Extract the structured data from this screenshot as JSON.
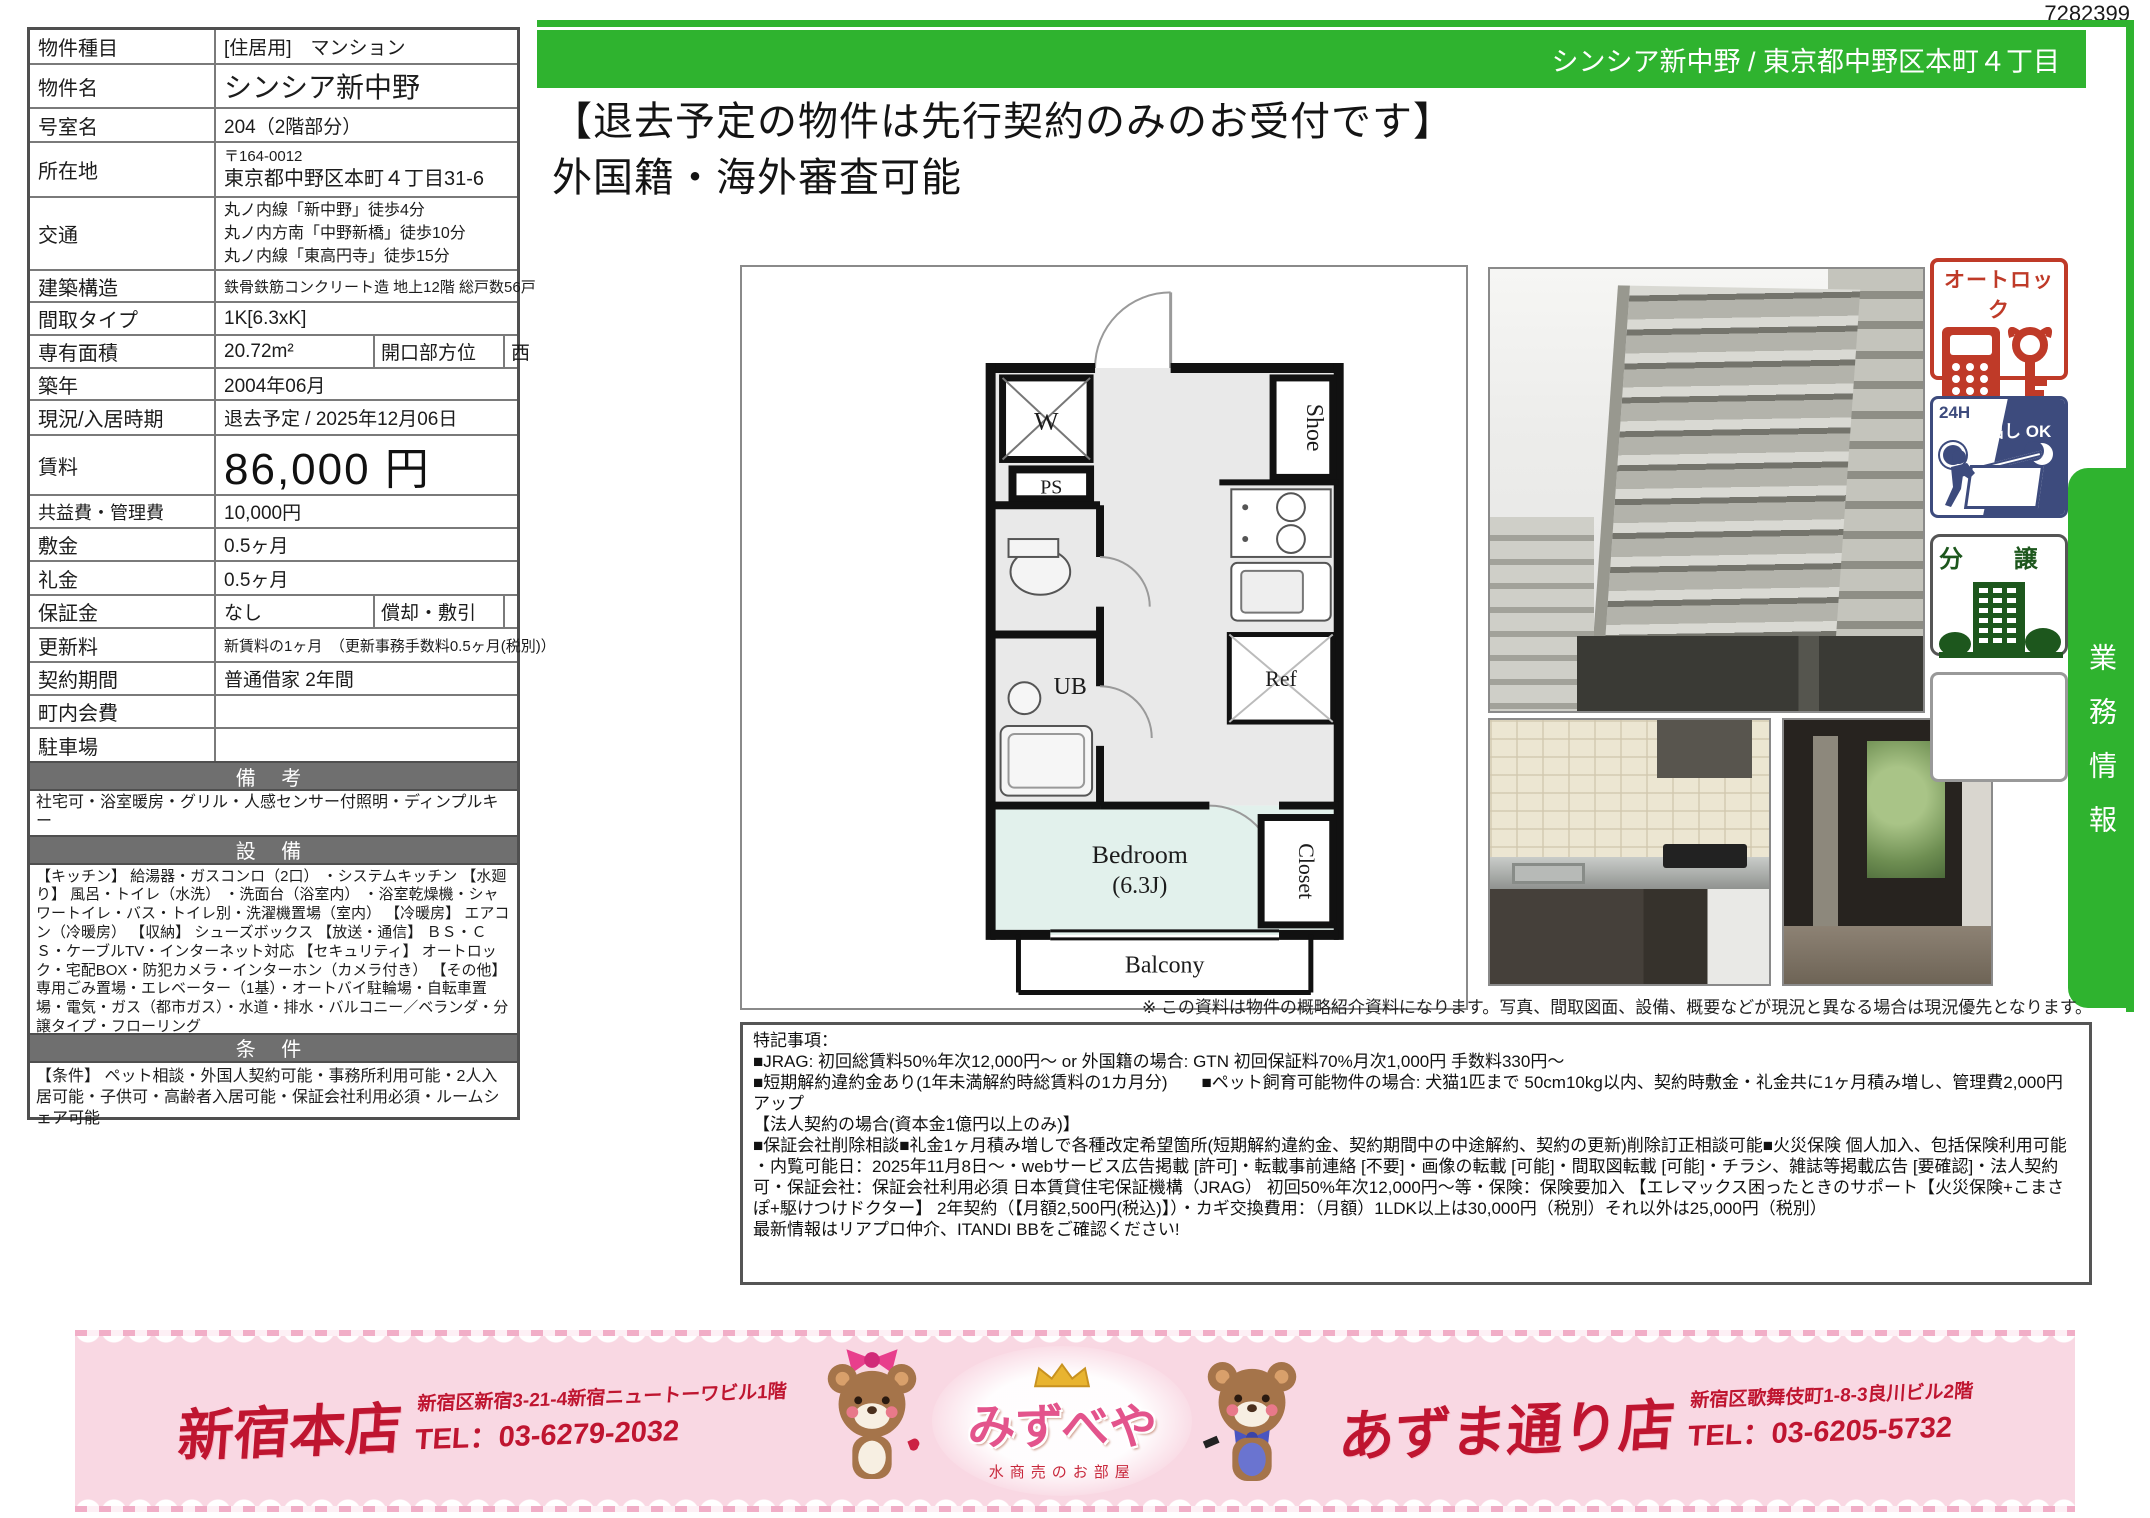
{
  "doc": {
    "id": "7282399"
  },
  "colors": {
    "accent_green": "#2fb32f",
    "section_gray": "#6f6f6f",
    "autolock_red": "#bf3a28",
    "gomidashi_navy": "#3d4b7d",
    "bunjo_green": "#1d571d",
    "banner_pink": "#f9d8e3",
    "banner_red": "#bf1530"
  },
  "header": {
    "bar_text": "シンシア新中野 / 東京都中野区本町４丁目",
    "headline_line1": "【退去予定の物件は先行契約のみのお受付です】",
    "headline_line2": "外国籍・海外審査可能"
  },
  "table": {
    "rows": [
      {
        "label": "物件種目",
        "value": "[住居用]　マンション"
      },
      {
        "label": "物件名",
        "value": "シンシア新中野"
      },
      {
        "label": "号室名",
        "value": "204（2階部分）"
      },
      {
        "label": "所在地",
        "value_line1": "〒164-0012",
        "value_line2": "東京都中野区本町４丁目31-6"
      },
      {
        "label": "交通",
        "lines": [
          "丸ノ内線「新中野」徒歩4分",
          "丸ノ内方南「中野新橋」徒歩10分",
          "丸ノ内線「東高円寺」徒歩15分"
        ]
      },
      {
        "label": "建築構造",
        "value": "鉄骨鉄筋コンクリート造 地上12階 総戸数56戸"
      },
      {
        "label": "間取タイプ",
        "value": "1K[6.3xK]"
      },
      {
        "label": "専有面積",
        "value": "20.72m²",
        "label2": "開口部方位",
        "value2": "西"
      },
      {
        "label": "築年",
        "value": "2004年06月"
      },
      {
        "label": "現況/入居時期",
        "value": "退去予定 / 2025年12月06日"
      },
      {
        "label": "賃料",
        "value": "86,000 円"
      },
      {
        "label": "共益費・管理費",
        "value": "10,000円"
      },
      {
        "label": "敷金",
        "value": "0.5ヶ月"
      },
      {
        "label": "礼金",
        "value": "0.5ヶ月"
      },
      {
        "label": "保証金",
        "value": "なし",
        "label2": "償却・敷引",
        "value2": ""
      },
      {
        "label": "更新料",
        "value": "新賃料の1ヶ月　（更新事務手数料0.5ヶ月(税別)）"
      },
      {
        "label": "契約期間",
        "value": "普通借家 2年間"
      },
      {
        "label": "町内会費",
        "value": ""
      },
      {
        "label": "駐車場",
        "value": ""
      }
    ],
    "sections": {
      "biko_title": "備 考",
      "biko_text": "社宅可・浴室暖房・グリル・人感センサー付照明・ディンプルキー",
      "setsubi_title": "設 備",
      "setsubi_text": "【キッチン】 給湯器・ガスコンロ（2口） ・システムキッチン 【水廻り】 風呂・トイレ（水洗） ・洗面台（浴室内） ・浴室乾燥機・シャワートイレ・バス・トイレ別・洗濯機置場（室内） 【冷暖房】 エアコン（冷暖房） 【収納】 シューズボックス 【放送・通信】 ＢＳ・ＣＳ・ケーブルTV・インターネット対応 【セキュリティ】 オートロック・宅配BOX・防犯カメラ・インターホン（カメラ付き） 【その他】 専用ごみ置場・エレベーター（1基）・オートバイ駐輪場・自転車置場・電気・ガス（都市ガス）・水道・排水・バルコニー／ベランダ・分譲タイプ・フローリング",
      "joken_title": "条 件",
      "joken_text": "【条件】 ペット相談・外国人契約可能・事務所利用可能・2人入居可能・子供可・高齢者入居可能・保証会社利用必須・ルームシェア可能"
    }
  },
  "floorplan": {
    "labels": {
      "w": "W",
      "ps": "PS",
      "shoe": "Shoe",
      "ref": "Ref",
      "ub": "UB",
      "closet": "Closet",
      "bedroom": "Bedroom",
      "bedroom_size": "(6.3J)",
      "balcony": "Balcony"
    }
  },
  "badges": {
    "autolock": "オートロック",
    "gomi_line1": "24H",
    "gomi_line2": "ゴミ出し OK",
    "bunjo": "分 譲"
  },
  "side_tab": {
    "text": "業務情報"
  },
  "disclaimer": "※ この資料は物件の概略紹介資料になります。写真、間取図面、設備、概要などが現況と異なる場合は現況優先となります。",
  "notes": {
    "lines": [
      "特記事項：",
      "■JRAG: 初回総賃料50%年次12,000円～ or 外国籍の場合: GTN 初回保証料70%月次1,000円 手数料330円～",
      "■短期解約違約金あり(1年未満解約時総賃料の1カ月分)　　■ペット飼育可能物件の場合: 犬猫1匹まで 50cm10kg以内、契約時敷金・礼金共に1ヶ月積み増し、管理費2,000円アップ",
      "【法人契約の場合(資本金1億円以上のみ)】",
      "■保証会社削除相談■礼金1ヶ月積み増しで各種改定希望箇所(短期解約違約金、契約期間中の中途解約、契約の更新)削除訂正相談可能■火災保険 個人加入、包括保険利用可能",
      "・内覧可能日：2025年11月8日～・webサービス広告掲載 [許可]・転載事前連絡 [不要]・画像の転載 [可能]・間取図転載 [可能]・チラシ、雑誌等掲載広告 [要確認]・法人契約可・保証会社：保証会社利用必須 日本賃貸住宅保証機構（JRAG） 初回50%年次12,000円～等・保険：保険要加入 【エレマックス困ったときのサポート【火災保険+こまさぽ+駆けつけドクター】 2年契約（【月額2,500円(税込)】）・カギ交換費用：（月額）1LDK以上は30,000円（税別）それ以外は25,000円（税別）",
      "最新情報はリアプロ仲介、ITANDI BBをご確認ください!"
    ]
  },
  "footer": {
    "shop_left": {
      "name": "新宿本店",
      "address": "新宿区新宿3-21-4新宿ニュートーワビル1階",
      "tel": "TEL：03-6279-2032"
    },
    "logo": {
      "name": "みずべや",
      "subtitle": "水商売のお部屋"
    },
    "shop_right": {
      "name": "あずま通り店",
      "address": "新宿区歌舞伎町1-8-3良川ビル2階",
      "tel": "TEL：03-6205-5732"
    }
  }
}
